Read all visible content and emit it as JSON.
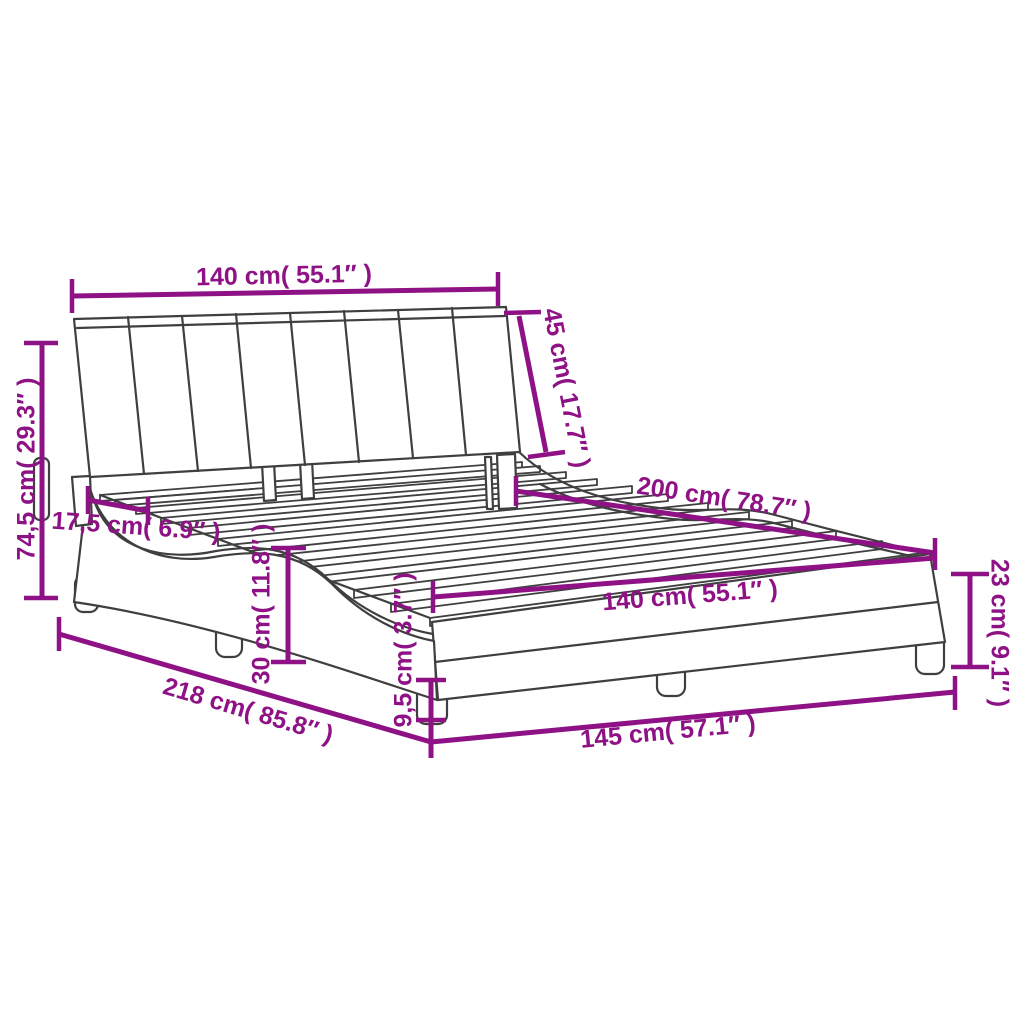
{
  "diagram": {
    "type": "product-dimension-diagram",
    "subject": "bed frame with headboard and slats",
    "colors": {
      "dimension": "#8e1285",
      "line_art": "#3f3f3f",
      "background": "#ffffff"
    },
    "labels": {
      "headboard_width": "140 cm( 55.1″ )",
      "headboard_height": "45 cm( 17.7″ )",
      "total_height": "74,5 cm( 29.3″ )",
      "headboard_depth": "17,5 cm( 6.9″ )",
      "inner_length": "200 cm( 78.7″ )",
      "inner_width": "140 cm( 55.1″ )",
      "side_rail_height": "30 cm( 11.8″ )",
      "leg_height": "9,5 cm( 3.7″ )",
      "total_length": "218 cm( 85.8″ )",
      "total_width": "145 cm( 57.1″ )",
      "foot_height": "23 cm( 9.1″ )"
    }
  }
}
